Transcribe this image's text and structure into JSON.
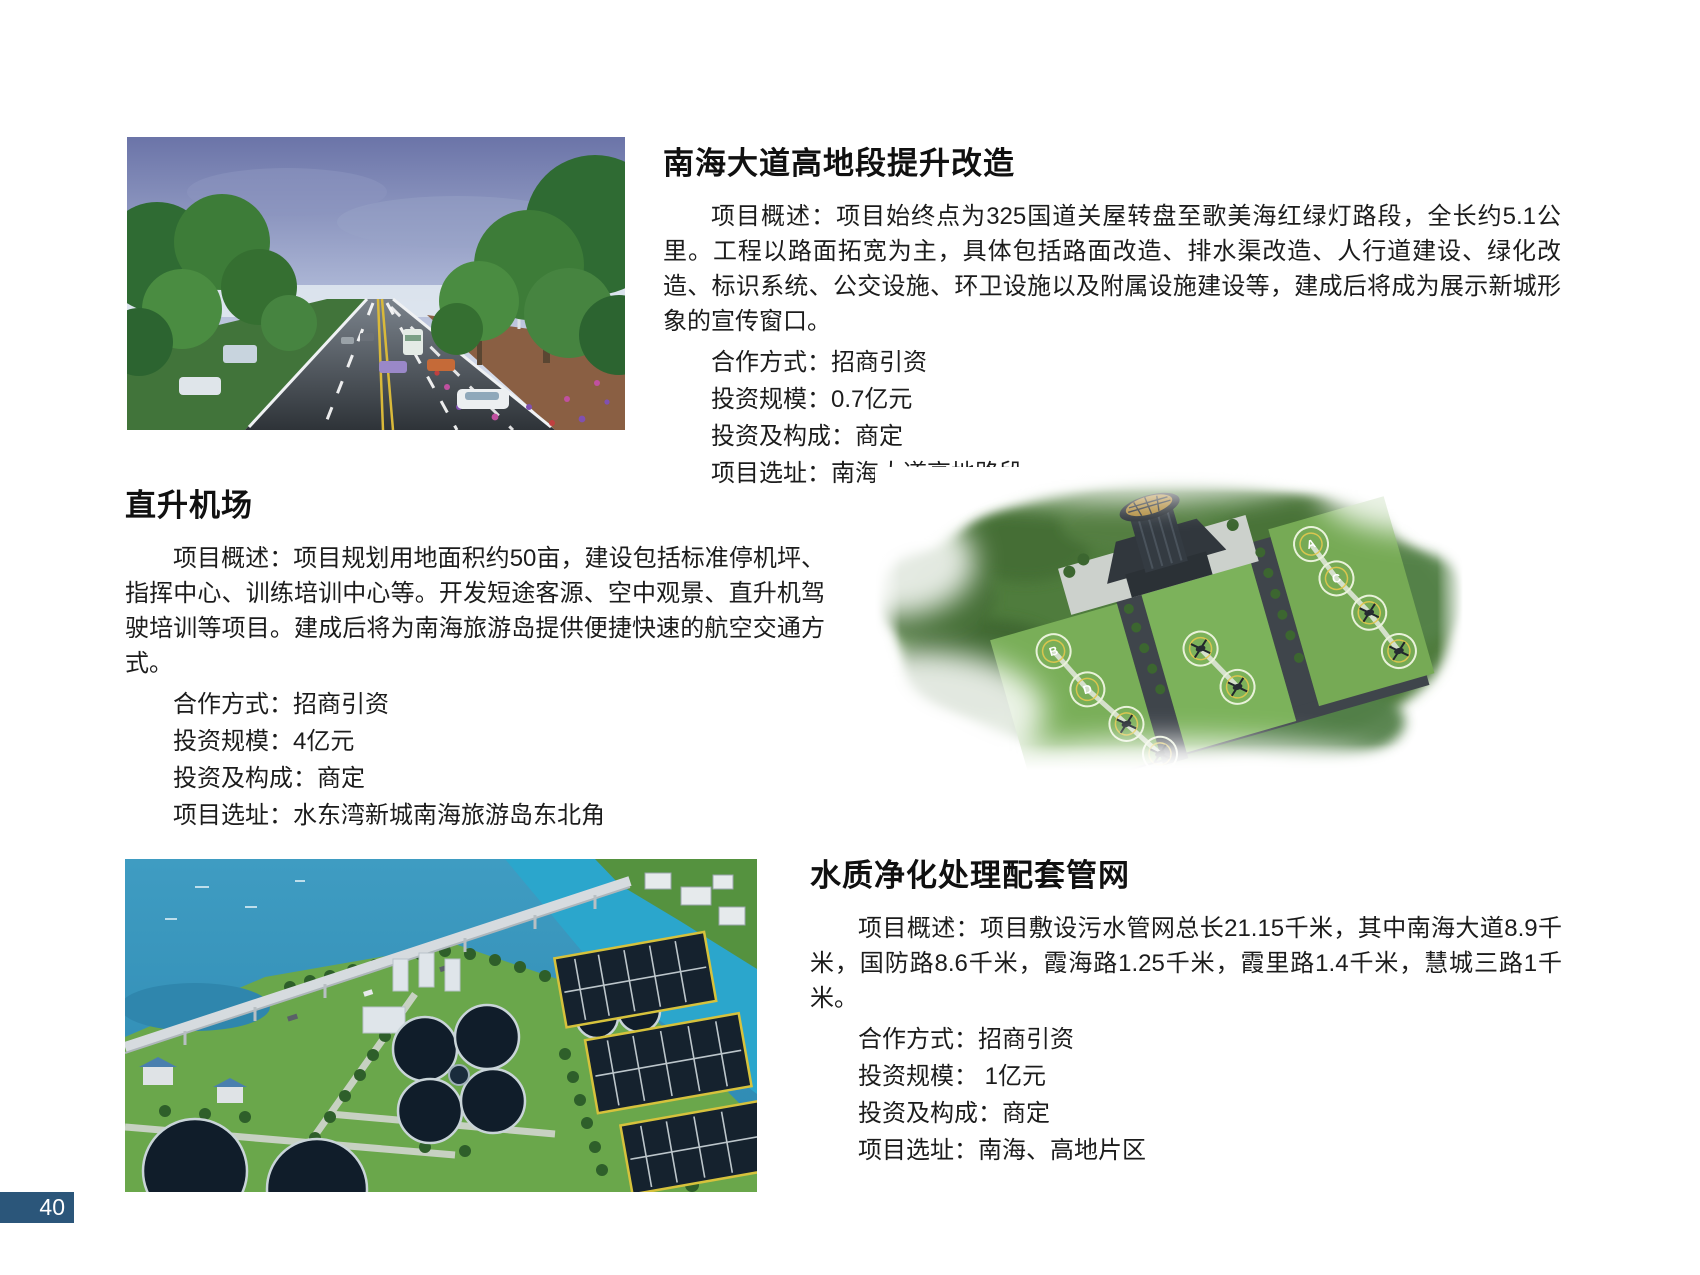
{
  "page_number": "40",
  "badge_color": "#2b567a",
  "sections": [
    {
      "id": "nanhai-avenue-upgrade",
      "title": "南海大道高地段提升改造",
      "overview": "项目概述：项目始终点为325国道关屋转盘至歌美海红绿灯路段，全长约5.1公里。工程以路面拓宽为主，具体包括路面改造、排水渠改造、人行道建设、绿化改造、标识系统、公交设施、环卫设施以及附属设施建设等，建成后将成为展示新城形象的宣传窗口。",
      "details": [
        "合作方式：招商引资",
        "投资规模：0.7亿元",
        "投资及构成：商定",
        "项目选址：南海大道高地路段"
      ],
      "image": "tree-lined-road-rendering"
    },
    {
      "id": "heliport",
      "title": "直升机场",
      "overview": "项目概述：项目规划用地面积约50亩，建设包括标准停机坪、指挥中心、训练培训中心等。开发短途客源、空中观景、直升机驾驶培训等项目。建成后将为南海旅游岛提供便捷快速的航空交通方式。",
      "details": [
        "合作方式：招商引资",
        "投资规模：4亿元",
        "投资及构成：商定",
        "项目选址：水东湾新城南海旅游岛东北角"
      ],
      "image": "heliport-aerial-rendering"
    },
    {
      "id": "water-purification-pipe-network",
      "title": "水质净化处理配套管网",
      "overview": "项目概述：项目敷设污水管网总长21.15千米，其中南海大道8.9千米，国防路8.6千米，霞海路1.25千米，霞里路1.4千米，慧城三路1千米。",
      "details": [
        "合作方式：招商引资",
        "投资规模： 1亿元",
        "投资及构成：商定",
        "项目选址：南海、高地片区"
      ],
      "image": "water-treatment-plant-aerial-photo"
    }
  ]
}
